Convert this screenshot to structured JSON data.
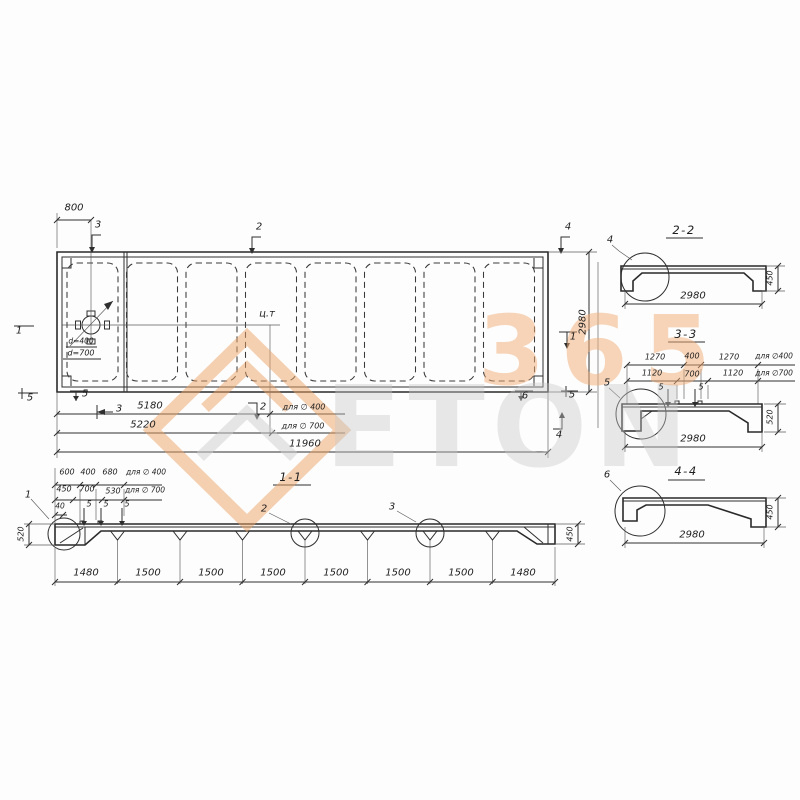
{
  "watermark": {
    "word": "ETON",
    "number": "365"
  },
  "plan": {
    "ct": "ц.т",
    "hole": {
      "d400": "d=400",
      "d700": "d=700"
    },
    "dims": {
      "top": "800",
      "row1": "5180",
      "row1_note": "для ∅ 400",
      "row2": "5220",
      "row2_note": "для ∅ 700",
      "total": "11960",
      "height": "2980"
    },
    "markers": {
      "m3_top": "3",
      "m2_top": "2",
      "m4_top": "4",
      "m1_left": "1",
      "m5_left": "5",
      "m5_bottom": "5",
      "m3_bottom": "3",
      "m2_bottom": "2",
      "m6_bottom": "6",
      "m5_right": "5",
      "m4_bottom": "4",
      "m1_right": "1"
    }
  },
  "section11": {
    "title": "1-1",
    "top_row1": [
      "600",
      "400",
      "680"
    ],
    "top_row1_note": "для ∅ 400",
    "top_row2": [
      "450",
      "700",
      "530"
    ],
    "top_row2_note": "для ∅ 700",
    "small_dim": "40",
    "loop_marks": [
      "5",
      "5",
      "5"
    ],
    "details": {
      "d1": "1",
      "d2": "2",
      "d3": "3"
    },
    "left_height": "520",
    "right_height": "450",
    "bottom": [
      "1480",
      "1500",
      "1500",
      "1500",
      "1500",
      "1500",
      "1500",
      "1480"
    ]
  },
  "section22": {
    "title": "2-2",
    "detail": "4",
    "width": "2980",
    "height": "450"
  },
  "section33": {
    "title": "3-3",
    "detail": "5",
    "row1": [
      "1270",
      "400",
      "1270"
    ],
    "row1_note": "для ∅400",
    "row2": [
      "1120",
      "700",
      "1120"
    ],
    "row2_note": "для ∅700",
    "loop_marks": [
      "5",
      "5"
    ],
    "width": "2980",
    "height": "520"
  },
  "section44": {
    "title": "4-4",
    "detail": "6",
    "width": "2980",
    "height": "450"
  }
}
